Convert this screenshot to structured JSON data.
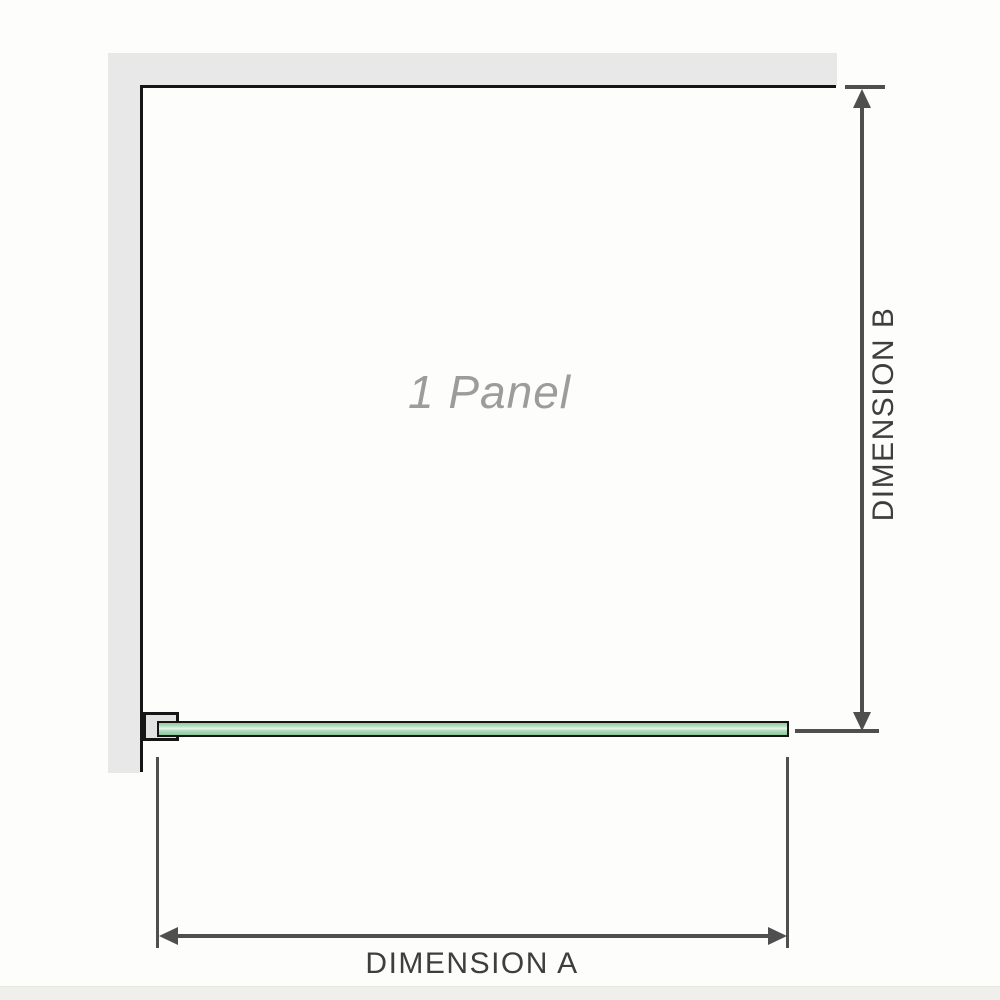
{
  "diagram": {
    "panel_label": "1 Panel",
    "dimension_a_label": "DIMENSION A",
    "dimension_b_label": "DIMENSION B"
  },
  "colors": {
    "background": "#fdfdfc",
    "wall": "#e8e8e8",
    "outline": "#151515",
    "glass_fill": "#a7dab6",
    "glass_highlight": "#e9f6ed",
    "dimension_line": "#4f4f4f",
    "label_text": "#3e3e3e",
    "panel_label_text": "#9c9c9c"
  }
}
